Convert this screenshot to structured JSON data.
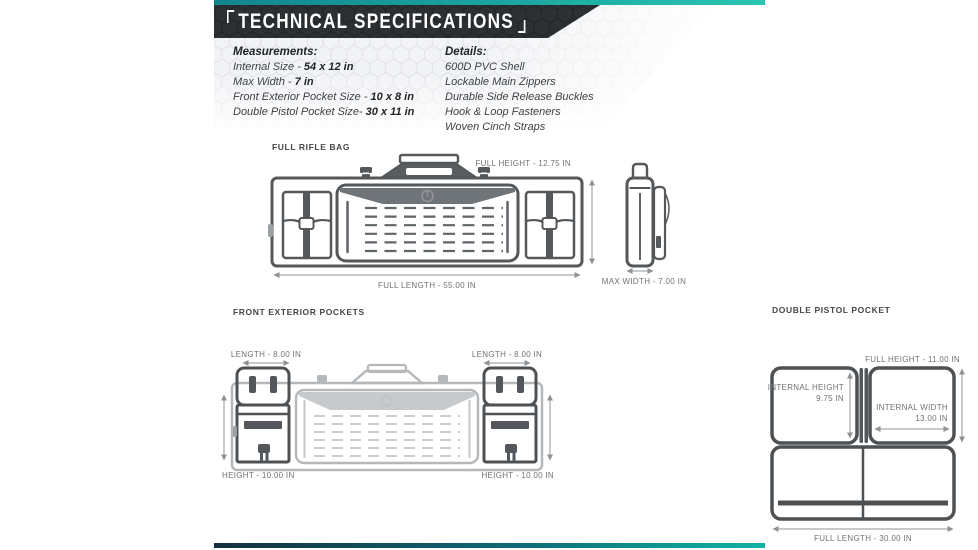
{
  "colors": {
    "accent_teal": "#11b3a6",
    "teal_top_gradient": [
      "#11858f",
      "#2ac4b2"
    ],
    "teal_bottom_gradient": [
      "#14303e",
      "#11b3a6"
    ],
    "header_bar": "#2c3033",
    "drawing_line_dark": "#54585b",
    "drawing_line_light": "#b5b8ba",
    "dimension_text": "#6e7376"
  },
  "header": {
    "title": "TECHNICAL SPECIFICATIONS"
  },
  "specs": {
    "measurements": {
      "heading": "Measurements:",
      "items": [
        {
          "label": "Internal Size - ",
          "value": "54 x 12 in"
        },
        {
          "label": "Max Width - ",
          "value": "7 in"
        },
        {
          "label": "Front Exterior Pocket Size - ",
          "value": "10 x 8 in"
        },
        {
          "label": "Double Pistol Pocket Size- ",
          "value": "30 x 11 in"
        }
      ]
    },
    "details": {
      "heading": "Details:",
      "items": [
        "600D PVC Shell",
        "Lockable Main Zippers",
        "Durable Side Release Buckles",
        "Hook & Loop Fasteners",
        "Woven Cinch Straps"
      ]
    }
  },
  "diagrams": {
    "full_rifle_bag": {
      "title": "FULL RIFLE BAG",
      "full_height": "FULL HEIGHT - 12.75 IN",
      "full_length": "FULL LENGTH - 55.00 IN"
    },
    "side_view": {
      "max_width": "MAX WIDTH - 7.00 IN"
    },
    "front_pockets": {
      "title": "FRONT EXTERIOR POCKETS",
      "length_left": "LENGTH - 8.00 IN",
      "length_right": "LENGTH - 8.00 IN",
      "height_left": "HEIGHT - 10.00 IN",
      "height_right": "HEIGHT - 10.00 IN"
    },
    "double_pistol_pocket": {
      "title": "DOUBLE PISTOL POCKET",
      "full_height": "FULL HEIGHT - 11.00 IN",
      "internal_height_label": "INTERNAL HEIGHT",
      "internal_height_value": "9.75 IN",
      "internal_width_label": "INTERNAL WIDTH",
      "internal_width_value": "13.00 IN",
      "full_length": "FULL LENGTH - 30.00 IN"
    }
  }
}
